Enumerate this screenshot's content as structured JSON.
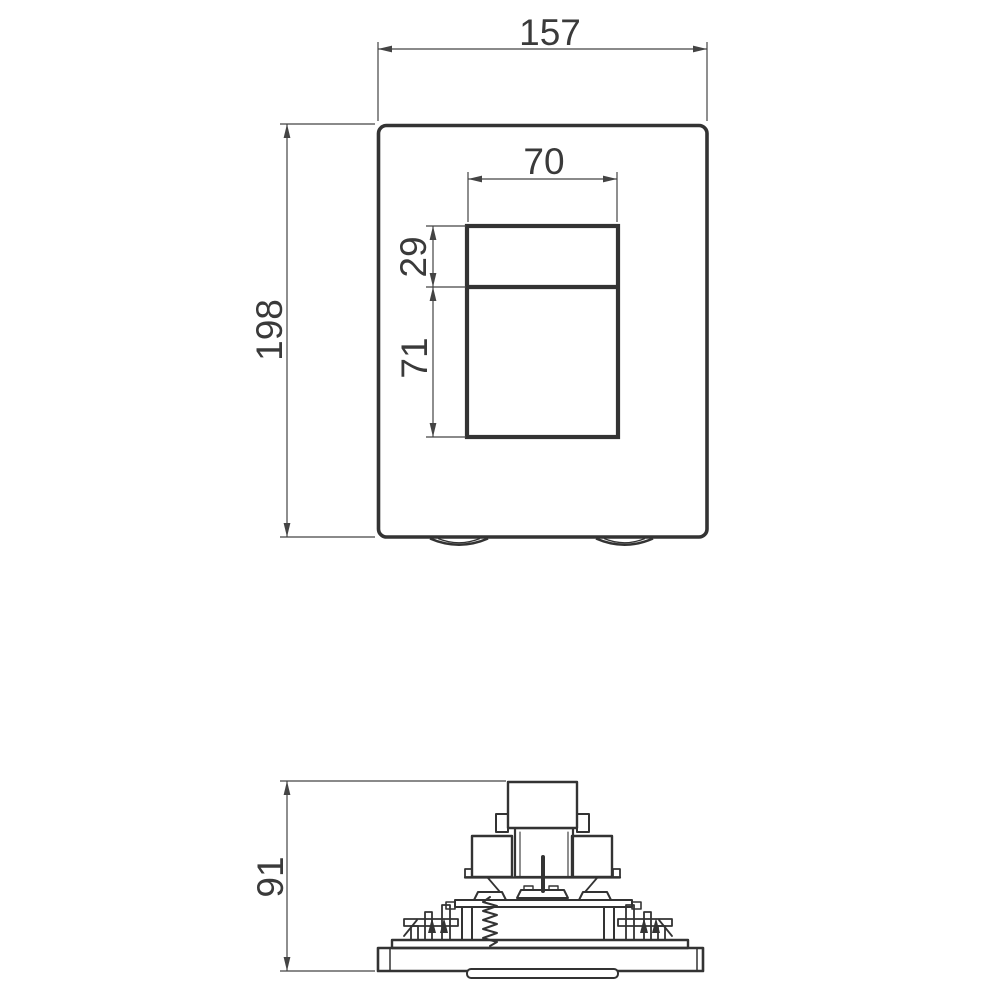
{
  "drawing_type": "technical drawing, flush plate front and side views",
  "front_view": {
    "overall_width": "157",
    "overall_height": "198",
    "opening_width": "70",
    "opening_upper_height": "29",
    "opening_lower_height": "71"
  },
  "side_view": {
    "overall_height": "91"
  },
  "colors": {
    "background": "#ffffff",
    "outline": "#333333",
    "dimension_line": "#444444",
    "text": "#3a3a3a"
  }
}
